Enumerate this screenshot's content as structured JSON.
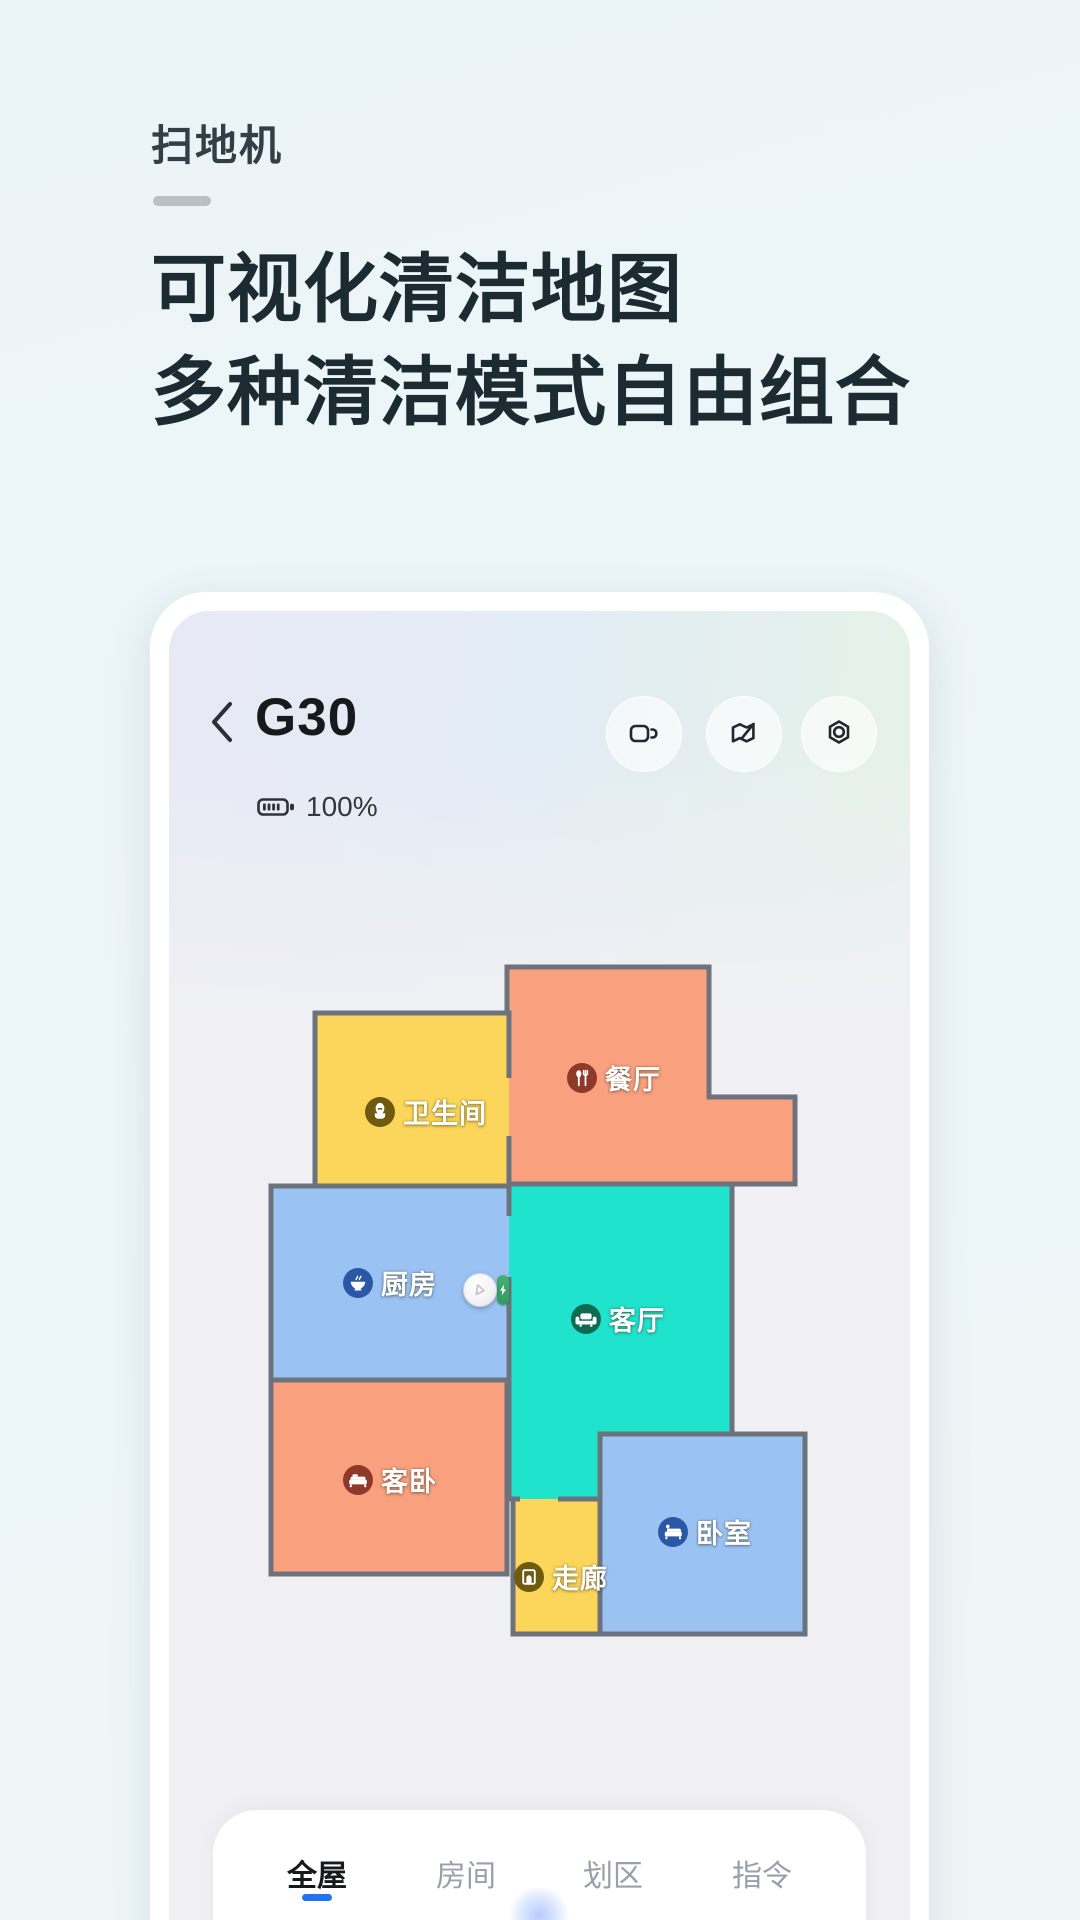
{
  "intro": {
    "title": "扫地机",
    "heading_line1": "可视化清洁地图",
    "heading_line2": "多种清洁模式自由组合"
  },
  "device": {
    "name": "G30",
    "battery_level": "100%"
  },
  "toolbar": {
    "buttons": [
      {
        "icon": "video-camera-icon"
      },
      {
        "icon": "map-edit-icon"
      },
      {
        "icon": "settings-icon"
      }
    ]
  },
  "map": {
    "wall_color": "#6D737C",
    "floor_background": "#EFEFF4",
    "rooms": [
      {
        "id": "bathroom",
        "name": "卫生间",
        "fill": "#FBD65A",
        "icon": "toilet-icon",
        "icon_bg": "#6F5A10"
      },
      {
        "id": "dining-room",
        "name": "餐厅",
        "fill": "#F9A07F",
        "icon": "cutlery-icon",
        "icon_bg": "#8E392A"
      },
      {
        "id": "kitchen",
        "name": "厨房",
        "fill": "#9AC3F3",
        "icon": "bowl-icon",
        "icon_bg": "#2B57A7"
      },
      {
        "id": "living-room",
        "name": "客厅",
        "fill": "#20E3CE",
        "icon": "sofa-icon",
        "icon_bg": "#0F6B50"
      },
      {
        "id": "guest-bedroom",
        "name": "客卧",
        "fill": "#F9A07F",
        "icon": "bed-icon",
        "icon_bg": "#8E392A"
      },
      {
        "id": "corridor",
        "name": "走廊",
        "fill": "#FBD65A",
        "icon": "door-icon",
        "icon_bg": "#6F5A10"
      },
      {
        "id": "bedroom",
        "name": "卧室",
        "fill": "#9AC3F3",
        "icon": "bed-lamp-icon",
        "icon_bg": "#2B57A7"
      }
    ]
  },
  "robot": {
    "body_icon": "robot-vacuum",
    "dock_icon": "charging-bolt",
    "dock_color": "#35A364"
  },
  "tabs": {
    "active_color": "#2273F0",
    "items": [
      {
        "label": "全屋",
        "active": true
      },
      {
        "label": "房间",
        "active": false
      },
      {
        "label": "划区",
        "active": false
      },
      {
        "label": "指令",
        "active": false
      }
    ]
  }
}
